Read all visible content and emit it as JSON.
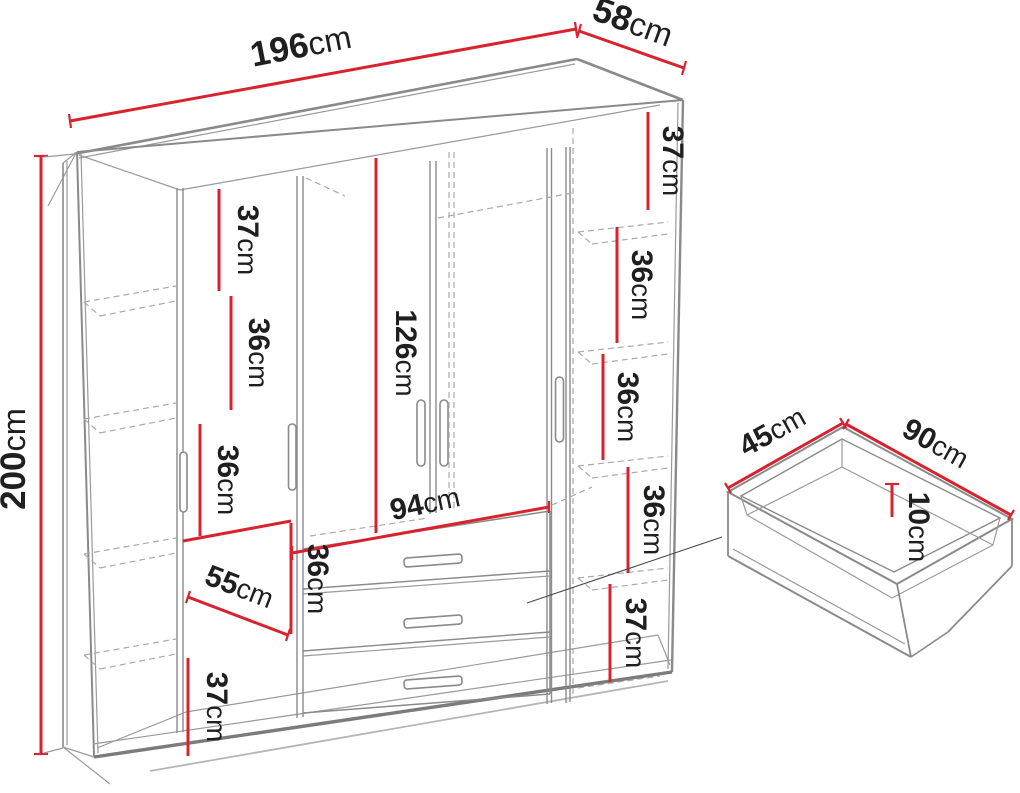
{
  "title": "Wardrobe dimension diagram",
  "colors": {
    "dimension_red": "#d8232e",
    "outline_gray": "#8a8a8a",
    "dashed_gray": "#a9a9a9",
    "shadow_gray": "#b5b5b5",
    "leader_gray": "#4a4a4a",
    "text": "#1f1f1f",
    "background": "#ffffff"
  },
  "wardrobe": {
    "width": {
      "value": "196",
      "unit": "cm"
    },
    "depth": {
      "value": "58",
      "unit": "cm"
    },
    "height": {
      "value": "200",
      "unit": "cm"
    },
    "center_section_height": {
      "value": "126",
      "unit": "cm"
    },
    "center_section_width": {
      "value": "94",
      "unit": "cm"
    },
    "left_shelves": [
      {
        "value": "37",
        "unit": "cm"
      },
      {
        "value": "36",
        "unit": "cm"
      },
      {
        "value": "36",
        "unit": "cm"
      },
      {
        "value": "55",
        "unit": "cm"
      },
      {
        "value": "36",
        "unit": "cm"
      },
      {
        "value": "37",
        "unit": "cm"
      }
    ],
    "right_shelves": [
      {
        "value": "37",
        "unit": "cm"
      },
      {
        "value": "36",
        "unit": "cm"
      },
      {
        "value": "36",
        "unit": "cm"
      },
      {
        "value": "36",
        "unit": "cm"
      },
      {
        "value": "37",
        "unit": "cm"
      }
    ]
  },
  "drawer": {
    "depth": {
      "value": "45",
      "unit": "cm"
    },
    "width": {
      "value": "90",
      "unit": "cm"
    },
    "height": {
      "value": "10",
      "unit": "cm"
    }
  }
}
